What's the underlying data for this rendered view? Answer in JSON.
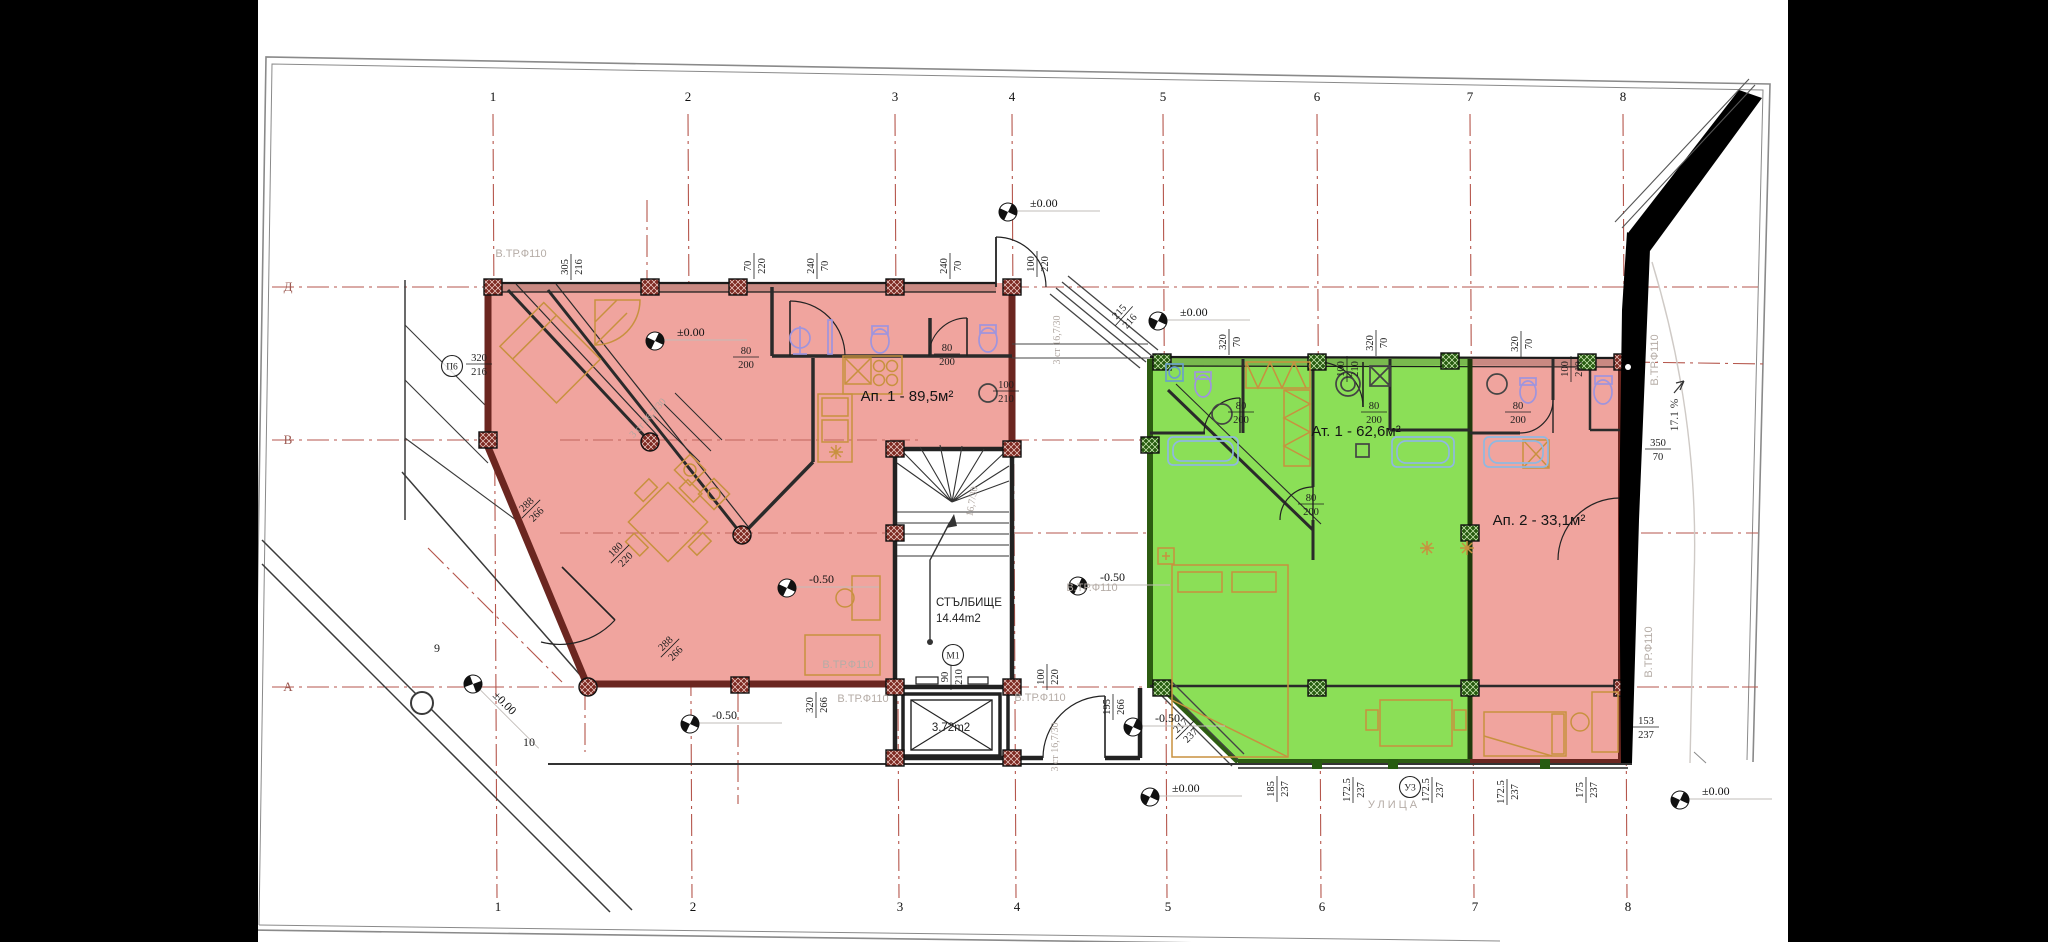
{
  "apartments": [
    {
      "label": "Ап. 1 - 89,5м²",
      "x": 907,
      "y": 401
    },
    {
      "label": "Ат. 1 - 62,6м²",
      "x": 1356,
      "y": 436
    },
    {
      "label": "Ап. 2 - 33,1м²",
      "x": 1539,
      "y": 525
    }
  ],
  "stairwell": {
    "name": "СТЪЛБИЩЕ",
    "area": "14.44m2"
  },
  "elevator": {
    "area": "3.72m2"
  },
  "street": {
    "name": "УЛИЦА"
  },
  "ramp": {
    "slope": "17.1 %"
  },
  "grid": {
    "columns": [
      {
        "n": "1",
        "x": 493
      },
      {
        "n": "2",
        "x": 688
      },
      {
        "n": "3",
        "x": 895
      },
      {
        "n": "4",
        "x": 1012
      },
      {
        "n": "5",
        "x": 1163
      },
      {
        "n": "6",
        "x": 1317
      },
      {
        "n": "7",
        "x": 1470
      },
      {
        "n": "8",
        "x": 1623
      }
    ],
    "top_y": 101,
    "bottom_y": 911,
    "rows": [
      {
        "n": "Д",
        "x": 288,
        "y": 291
      },
      {
        "n": "В",
        "x": 288,
        "y": 444
      },
      {
        "n": "А",
        "x": 288,
        "y": 691
      }
    ]
  },
  "site_points": [
    {
      "n": "9",
      "x": 437,
      "y": 652
    },
    {
      "n": "10",
      "x": 529,
      "y": 746
    }
  ],
  "axis_tags": [
    {
      "t": "П6",
      "x": 452,
      "y": 366
    },
    {
      "t": "М1",
      "x": 953,
      "y": 655
    },
    {
      "t": "У3",
      "x": 1410,
      "y": 787
    }
  ],
  "levels": [
    {
      "v": "±0.00",
      "mx": 655,
      "my": 341,
      "rot": 0
    },
    {
      "v": "±0.00",
      "mx": 1008,
      "my": 212,
      "rot": 0
    },
    {
      "v": "±0.00",
      "mx": 1158,
      "my": 321,
      "rot": 0
    },
    {
      "v": "±0.00",
      "mx": 1150,
      "my": 797,
      "rot": 0
    },
    {
      "v": "±0.00",
      "mx": 1680,
      "my": 800,
      "rot": 0
    },
    {
      "v": "±0.00",
      "mx": 473,
      "my": 684,
      "rot": 45
    },
    {
      "v": "-0.50",
      "mx": 787,
      "my": 588,
      "rot": 0
    },
    {
      "v": "-0.50",
      "mx": 1078,
      "my": 586,
      "rot": 0
    },
    {
      "v": "-0.50",
      "mx": 690,
      "my": 724,
      "rot": 0
    },
    {
      "v": "-0.50",
      "mx": 1133,
      "my": 727,
      "rot": 0
    }
  ],
  "dims": [
    {
      "a": "305",
      "b": "216",
      "x": 571,
      "y": 267,
      "r": -90
    },
    {
      "a": "70",
      "b": "220",
      "x": 754,
      "y": 266,
      "r": -90
    },
    {
      "a": "240",
      "b": "70",
      "x": 817,
      "y": 266,
      "r": -90
    },
    {
      "a": "240",
      "b": "70",
      "x": 950,
      "y": 266,
      "r": -90
    },
    {
      "a": "100",
      "b": "220",
      "x": 1037,
      "y": 264,
      "r": -90
    },
    {
      "a": "215",
      "b": "216",
      "x": 1124,
      "y": 316,
      "r": -48
    },
    {
      "a": "320",
      "b": "70",
      "x": 1229,
      "y": 342,
      "r": -90
    },
    {
      "a": "320",
      "b": "70",
      "x": 1376,
      "y": 343,
      "r": -90
    },
    {
      "a": "320",
      "b": "70",
      "x": 1521,
      "y": 344,
      "r": -90
    },
    {
      "a": "100",
      "b": "210",
      "x": 1347,
      "y": 369,
      "r": -90
    },
    {
      "a": "100",
      "b": "210",
      "x": 1571,
      "y": 369,
      "r": -90
    },
    {
      "a": "100",
      "b": "210",
      "x": 1006,
      "y": 391,
      "r": 0
    },
    {
      "a": "80",
      "b": "200",
      "x": 746,
      "y": 357,
      "r": 0
    },
    {
      "a": "80",
      "b": "200",
      "x": 947,
      "y": 354,
      "r": 0
    },
    {
      "a": "80",
      "b": "200",
      "x": 1241,
      "y": 412,
      "r": 0
    },
    {
      "a": "80",
      "b": "200",
      "x": 1374,
      "y": 412,
      "r": 0
    },
    {
      "a": "80",
      "b": "200",
      "x": 1518,
      "y": 412,
      "r": 0
    },
    {
      "a": "80",
      "b": "200",
      "x": 1311,
      "y": 504,
      "r": 0
    },
    {
      "a": "320",
      "b": "216",
      "x": 479,
      "y": 364,
      "r": 0
    },
    {
      "a": "288",
      "b": "266",
      "x": 531,
      "y": 509,
      "r": -45
    },
    {
      "a": "288",
      "b": "266",
      "x": 670,
      "y": 648,
      "r": -45
    },
    {
      "a": "180",
      "b": "220",
      "x": 620,
      "y": 554,
      "r": -45
    },
    {
      "a": "90",
      "b": "210",
      "x": 951,
      "y": 677,
      "r": -90
    },
    {
      "a": "100",
      "b": "220",
      "x": 1047,
      "y": 677,
      "r": -90
    },
    {
      "a": "320",
      "b": "266",
      "x": 816,
      "y": 705,
      "r": -90
    },
    {
      "a": "195",
      "b": "266",
      "x": 1113,
      "y": 707,
      "r": -90
    },
    {
      "a": "217",
      "b": "237",
      "x": 1185,
      "y": 730,
      "r": -45
    },
    {
      "a": "185",
      "b": "237",
      "x": 1277,
      "y": 789,
      "r": -90
    },
    {
      "a": "172.5",
      "b": "237",
      "x": 1353,
      "y": 790,
      "r": -90
    },
    {
      "a": "172.5",
      "b": "237",
      "x": 1432,
      "y": 790,
      "r": -90
    },
    {
      "a": "172.5",
      "b": "237",
      "x": 1507,
      "y": 792,
      "r": -90
    },
    {
      "a": "175",
      "b": "237",
      "x": 1586,
      "y": 790,
      "r": -90
    },
    {
      "a": "153",
      "b": "237",
      "x": 1646,
      "y": 727,
      "r": 0
    },
    {
      "a": "350",
      "b": "70",
      "x": 1658,
      "y": 449,
      "r": 0
    }
  ],
  "pipe_labels": [
    {
      "t": "В.ТР.Ф110",
      "x": 521,
      "y": 257,
      "r": 0
    },
    {
      "t": "В.ТР.Ф110",
      "x": 848,
      "y": 668,
      "r": 0
    },
    {
      "t": "В.ТР.Ф110",
      "x": 863,
      "y": 702,
      "r": 0
    },
    {
      "t": "В.ТР.Ф110",
      "x": 1040,
      "y": 701,
      "r": 0
    },
    {
      "t": "В.ТР.Ф110",
      "x": 1092,
      "y": 591,
      "r": 0
    },
    {
      "t": "В.ТР.Ф110",
      "x": 1658,
      "y": 360,
      "r": -90
    },
    {
      "t": "В.ТР.Ф110",
      "x": 1652,
      "y": 652,
      "r": -90
    }
  ],
  "stair_notes": [
    {
      "t": "3 ст 16,7/30",
      "x": 650,
      "y": 420,
      "r": -48
    },
    {
      "t": "16,7/30",
      "x": 975,
      "y": 502,
      "r": -80
    },
    {
      "t": "3 ст 16,7/30",
      "x": 1060,
      "y": 340,
      "r": -90
    },
    {
      "t": "3 ст 16,7/30",
      "x": 1058,
      "y": 747,
      "r": -90
    }
  ],
  "colors": {
    "letterbox": "#000000",
    "paper": "#ffffff",
    "grid_line": "#b5564c",
    "apartment_fill": "#f0a49e",
    "apartment_wall": "#6b2620",
    "column_red": "#7e2a22",
    "green_fill": "#8bdf57",
    "green_wall": "#2d5c12",
    "column_green": "#275c10",
    "gray_label": "#b5aca6",
    "furniture": "#c8913f",
    "fixture": "#9f94dd",
    "tub": "#8fb8e0"
  }
}
